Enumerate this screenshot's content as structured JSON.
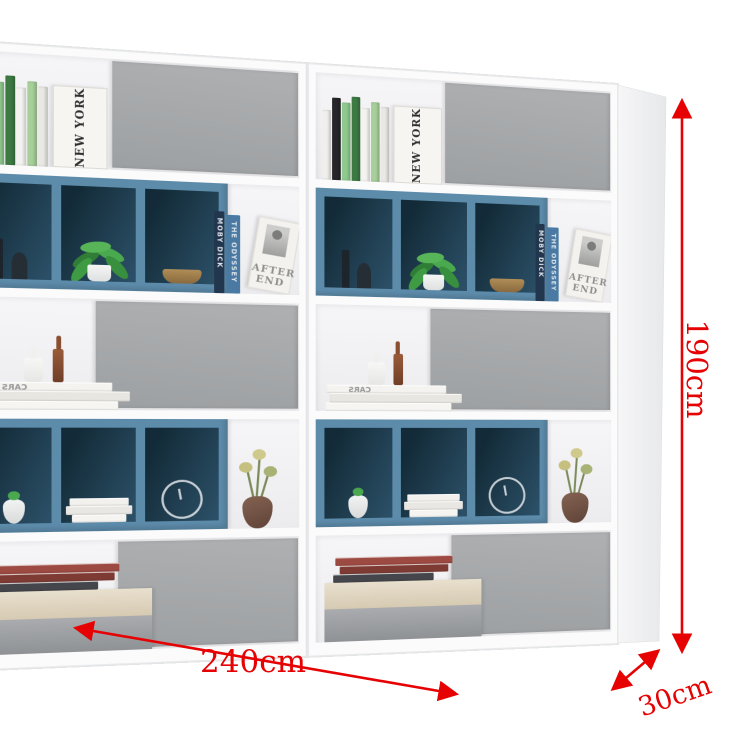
{
  "dimensions": {
    "width": "240cm",
    "height": "190cm",
    "depth": "30cm"
  },
  "accent_color": "#e60202",
  "colors": {
    "panel_gray": "#a6a8aa",
    "cube_blue": "#5d8cab",
    "cube_interior_dark": "#18323f",
    "frame_white": "#fbfbfc",
    "background": "#ffffff"
  },
  "books": {
    "new_york": "NEW YORK",
    "moby_dick": "MOBY DICK",
    "odyssey": "THE ODYSSEY",
    "after_line1": "AFTER",
    "after_line2": "END",
    "cars": "CARS"
  },
  "top_spines": [
    {
      "c": "#f0efec",
      "h": 66
    },
    {
      "c": "#26262a",
      "h": 78
    },
    {
      "c": "#8fc98f",
      "h": 74
    },
    {
      "c": "#3d7a43",
      "h": 80
    },
    {
      "c": "#f4f3f0",
      "h": 70
    },
    {
      "c": "#a7cf9a",
      "h": 76
    },
    {
      "c": "#e9e8e4",
      "h": 72
    }
  ],
  "mid_stack_books": [
    {
      "c": "#f4f3f0",
      "w": 112,
      "h": 8
    },
    {
      "c": "#e8e6e1",
      "w": 124,
      "h": 9
    },
    {
      "c": "#f6f5f2",
      "w": 118,
      "h": 8
    }
  ],
  "cube_stack_books": [
    {
      "c": "#f2f1ee",
      "w": 50,
      "h": 7
    },
    {
      "c": "#e9e7e3",
      "w": 56,
      "h": 8
    },
    {
      "c": "#f5f4f1",
      "w": 46,
      "h": 7
    }
  ],
  "chest_books": [
    {
      "c": "#9c4a42",
      "w": 110,
      "h": 8
    },
    {
      "c": "#7e3b34",
      "w": 102,
      "h": 8
    },
    {
      "c": "#45464b",
      "w": 94,
      "h": 8
    }
  ]
}
